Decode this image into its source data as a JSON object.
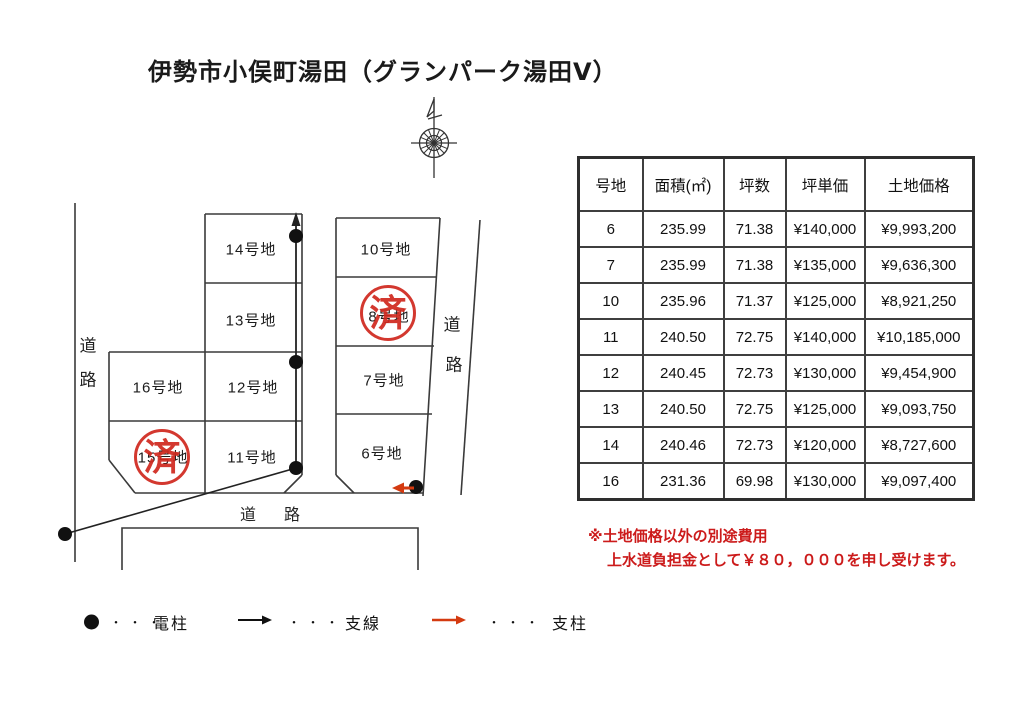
{
  "title": "伊勢市小俣町湯田（グランパーク湯田Ⅴ）",
  "map": {
    "plots": [
      {
        "label": "14号地"
      },
      {
        "label": "10号地"
      },
      {
        "label": "13号地"
      },
      {
        "label": "8号地"
      },
      {
        "label": "16号地"
      },
      {
        "label": "12号地"
      },
      {
        "label": "7号地"
      },
      {
        "label": "15号地"
      },
      {
        "label": "11号地"
      },
      {
        "label": "6号地"
      }
    ],
    "sold_stamp": "済",
    "road_left": [
      "道",
      "路"
    ],
    "road_right": [
      "道",
      "路"
    ],
    "road_bottom": "道　路"
  },
  "table": {
    "headers": [
      "号地",
      "面積(㎡)",
      "坪数",
      "坪単価",
      "土地価格"
    ],
    "rows": [
      [
        "6",
        "235.99",
        "71.38",
        "¥140,000",
        "¥9,993,200"
      ],
      [
        "7",
        "235.99",
        "71.38",
        "¥135,000",
        "¥9,636,300"
      ],
      [
        "10",
        "235.96",
        "71.37",
        "¥125,000",
        "¥8,921,250"
      ],
      [
        "11",
        "240.50",
        "72.75",
        "¥140,000",
        "¥10,185,000"
      ],
      [
        "12",
        "240.45",
        "72.73",
        "¥130,000",
        "¥9,454,900"
      ],
      [
        "13",
        "240.50",
        "72.75",
        "¥125,000",
        "¥9,093,750"
      ],
      [
        "14",
        "240.46",
        "72.73",
        "¥120,000",
        "¥8,727,600"
      ],
      [
        "16",
        "231.36",
        "69.98",
        "¥130,000",
        "¥9,097,400"
      ]
    ]
  },
  "note": {
    "line1": "※土地価格以外の別途費用",
    "line2": "上水道負担金として￥８０，０００を申し受けます。"
  },
  "legend": {
    "separator": "・・・",
    "items": [
      {
        "label": "電柱"
      },
      {
        "label": "支線"
      },
      {
        "label": "支柱"
      }
    ]
  },
  "colors": {
    "stamp_red": "#d0281e",
    "note_red": "#cc1b1b",
    "arrow_red": "#d43a10",
    "line": "#3a3a3a"
  }
}
